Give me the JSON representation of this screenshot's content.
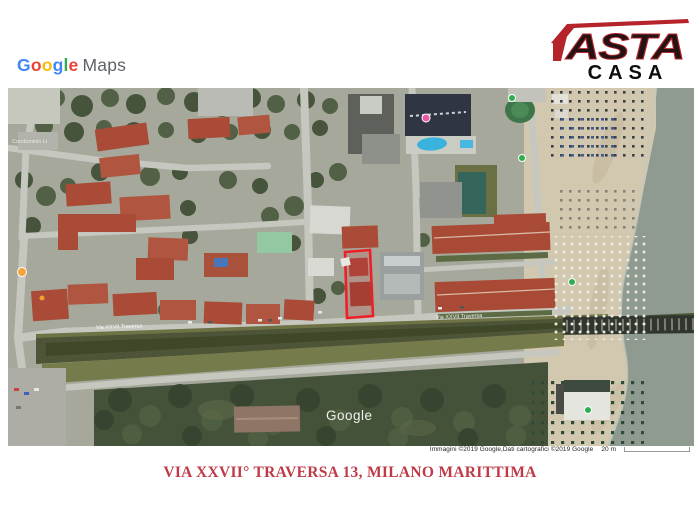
{
  "branding": {
    "google_maps": {
      "letters": [
        {
          "ch": "G",
          "style": "color:#4285F4"
        },
        {
          "ch": "o",
          "style": "color:#EA4335"
        },
        {
          "ch": "o",
          "style": "color:#FBBC05"
        },
        {
          "ch": "g",
          "style": "color:#4285F4"
        },
        {
          "ch": "l",
          "style": "color:#34A853"
        },
        {
          "ch": "e",
          "style": "color:#EA4335"
        }
      ],
      "maps_text": "Maps"
    },
    "asta": {
      "top": "ASTA",
      "bottom": "CASA",
      "accent_color": "#b5242a"
    }
  },
  "map": {
    "labels": {
      "condominio": "Condominio Li",
      "street_left": "Via XXVII Traversa",
      "street_right": "Via XXVII Traversa",
      "watermark": "Google"
    },
    "attribution": "Immagini ©2019 Google,Dati cartografici ©2019 Google",
    "scale_label": "20 m",
    "property_outline_color": "#ee1f26"
  },
  "caption": {
    "text": "VIA XXVII° TRAVERSA 13, MILANO MARITTIMA"
  }
}
